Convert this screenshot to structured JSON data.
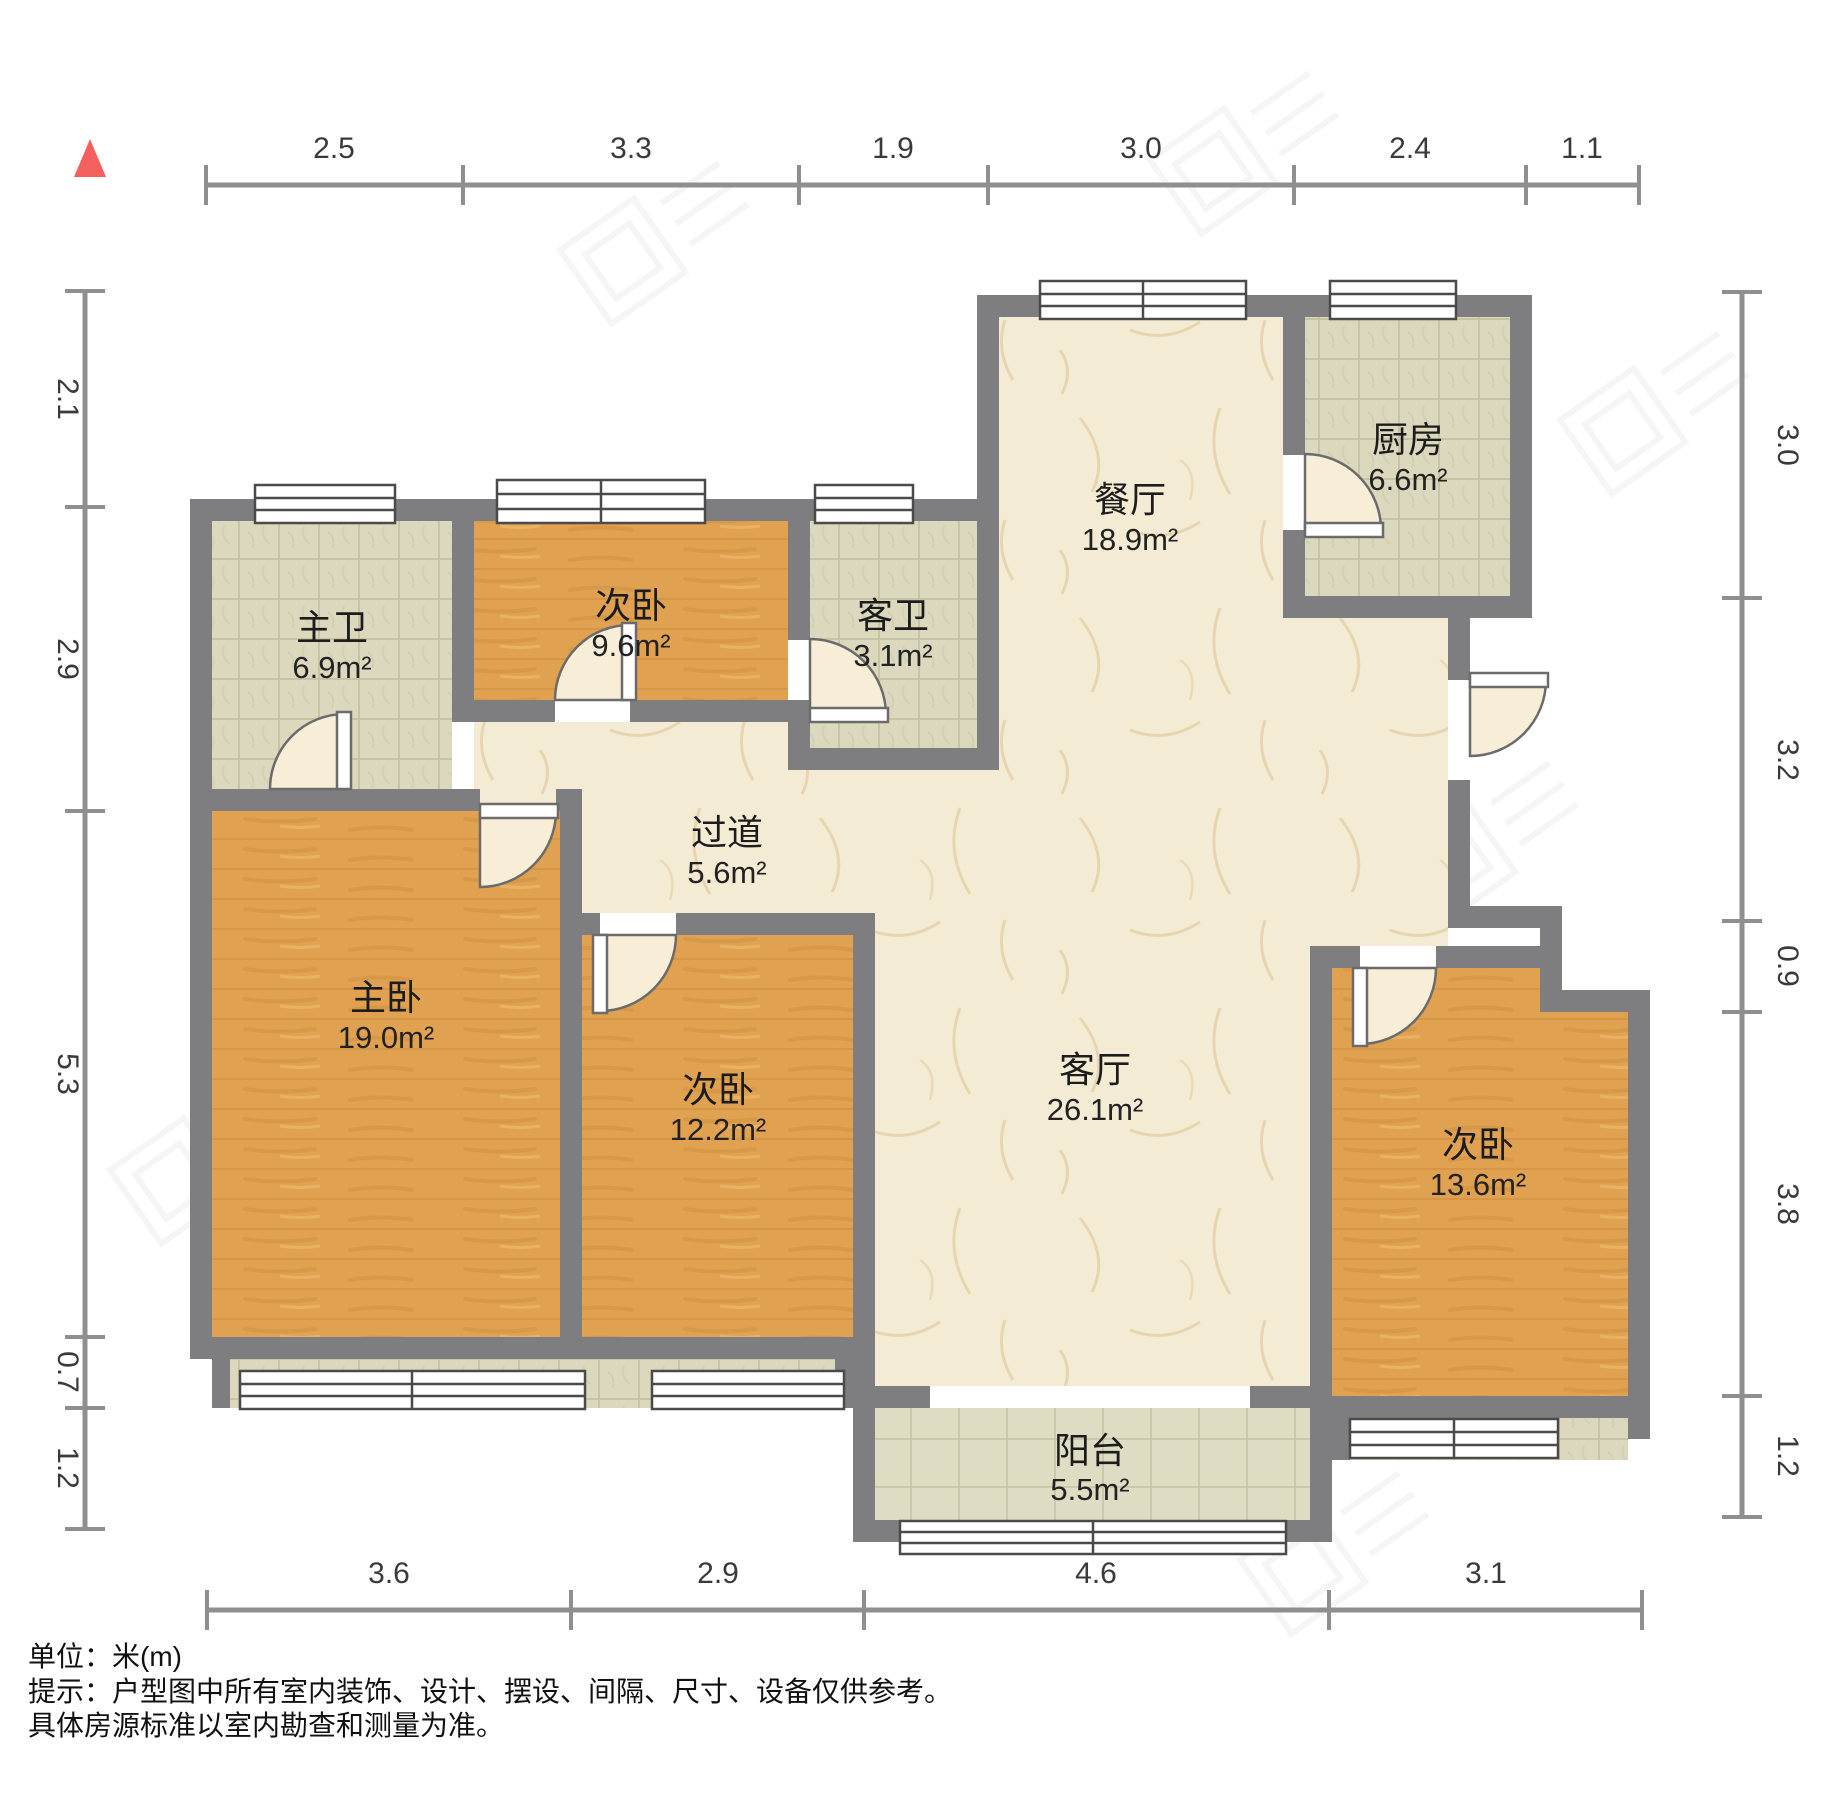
{
  "title_note": {
    "unit": "单位：米(m)",
    "line1": "提示：户型图中所有室内装饰、设计、摆设、间隔、尺寸、设备仅供参考。",
    "line2": "具体房源标准以室内勘查和测量为准。"
  },
  "compass": {
    "icon": "north-triangle",
    "color": "#f4605d"
  },
  "rooms": [
    {
      "name": "主卫",
      "area": "6.9m²",
      "floor": "tile"
    },
    {
      "name": "次卧",
      "area": "9.6m²",
      "floor": "wood"
    },
    {
      "name": "客卫",
      "area": "3.1m²",
      "floor": "tile"
    },
    {
      "name": "餐厅",
      "area": "18.9m²",
      "floor": "marble"
    },
    {
      "name": "厨房",
      "area": "6.6m²",
      "floor": "tile"
    },
    {
      "name": "主卧",
      "area": "19.0m²",
      "floor": "wood"
    },
    {
      "name": "过道",
      "area": "5.6m²",
      "floor": "marble"
    },
    {
      "name": "次卧",
      "area": "12.2m²",
      "floor": "wood"
    },
    {
      "name": "客厅",
      "area": "26.1m²",
      "floor": "marble"
    },
    {
      "name": "次卧",
      "area": "13.6m²",
      "floor": "wood"
    },
    {
      "name": "阳台",
      "area": "5.5m²",
      "floor": "tile"
    }
  ],
  "dimensions": {
    "top": [
      "2.5",
      "3.3",
      "1.9",
      "3.0",
      "2.4",
      "1.1"
    ],
    "left": [
      "2.1",
      "2.9",
      "5.3",
      "0.7",
      "1.2"
    ],
    "right": [
      "3.0",
      "3.2",
      "0.9",
      "3.8",
      "1.2"
    ],
    "bottom": [
      "3.6",
      "2.9",
      "4.6",
      "3.1"
    ]
  },
  "colors": {
    "wall": "#7e7e80",
    "wood_floor": "#e0a150",
    "tile_floor": "#dbd8bd",
    "marble_floor": "#f4ebd4",
    "dim_line": "#8f8f8f",
    "compass_red": "#f4605d"
  }
}
